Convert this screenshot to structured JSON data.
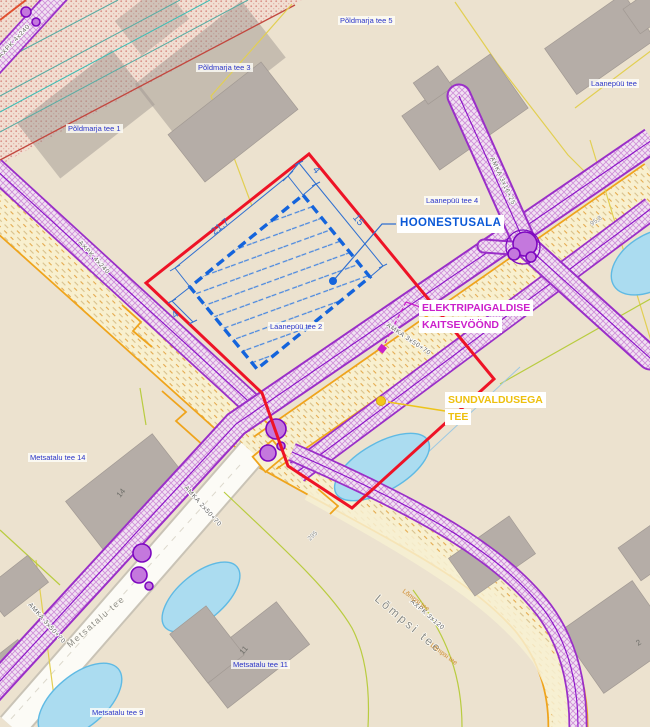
{
  "map": {
    "lot_labels": [
      {
        "text": "Põldmarja tee 5"
      },
      {
        "text": "Põldmarja tee 3"
      },
      {
        "text": "Põldmarja tee 1"
      },
      {
        "text": "Laanepüü tee"
      },
      {
        "text": "Laanepüü tee 4"
      },
      {
        "text": "Laanepüü tee 2"
      },
      {
        "text": "Metsatalu tee 14"
      },
      {
        "text": "Metsatalu tee 11"
      },
      {
        "text": "Metsatalu tee 9"
      }
    ],
    "annotations": {
      "hoonestusala": "HOONESTUSALA",
      "kaitsevoond_line1": "ELEKTRIPAIGALDISE",
      "kaitsevoond_line2": "KAITSEVÖÖND",
      "sundvaldus_line1": "SUNDVALDUSEGA",
      "sundvaldus_line2": "TEE"
    },
    "dimensions": {
      "width": "21,7",
      "depth": "15",
      "offset_top": "4",
      "offset_bottom": "4"
    },
    "cable_labels": [
      {
        "text": "AMKA 3x16+25"
      },
      {
        "text": "AMKA 3x50+70"
      },
      {
        "text": "AMKA 2x50+70"
      },
      {
        "text": "AMKA 3x50+70"
      },
      {
        "text": "AXPK 3x120"
      },
      {
        "text": "AXPK 4x240"
      },
      {
        "text": "AXPK 4x240"
      }
    ],
    "road_names": [
      {
        "text": "Metsatalu tee"
      },
      {
        "text": "Lõmpsi tee"
      },
      {
        "text": "Lõmpsi tee"
      },
      {
        "text": "Lõmpsi tee"
      }
    ],
    "parcel_numbers": [
      {
        "text": "95,8"
      },
      {
        "text": "295"
      }
    ],
    "building_numbers": [
      {
        "text": "14"
      },
      {
        "text": "11"
      },
      {
        "text": "2"
      }
    ],
    "colors": {
      "background": "#ece2cf",
      "plan_boundary_red": "#ee1326",
      "building_area_blue": "#1464dc",
      "protection_zone_purple": "#9a2fc8",
      "road_orange": "#efa41c",
      "label_magenta": "#cb1fcb",
      "label_yellow": "#eec00e",
      "pond_blue": "#abdcf0"
    }
  }
}
